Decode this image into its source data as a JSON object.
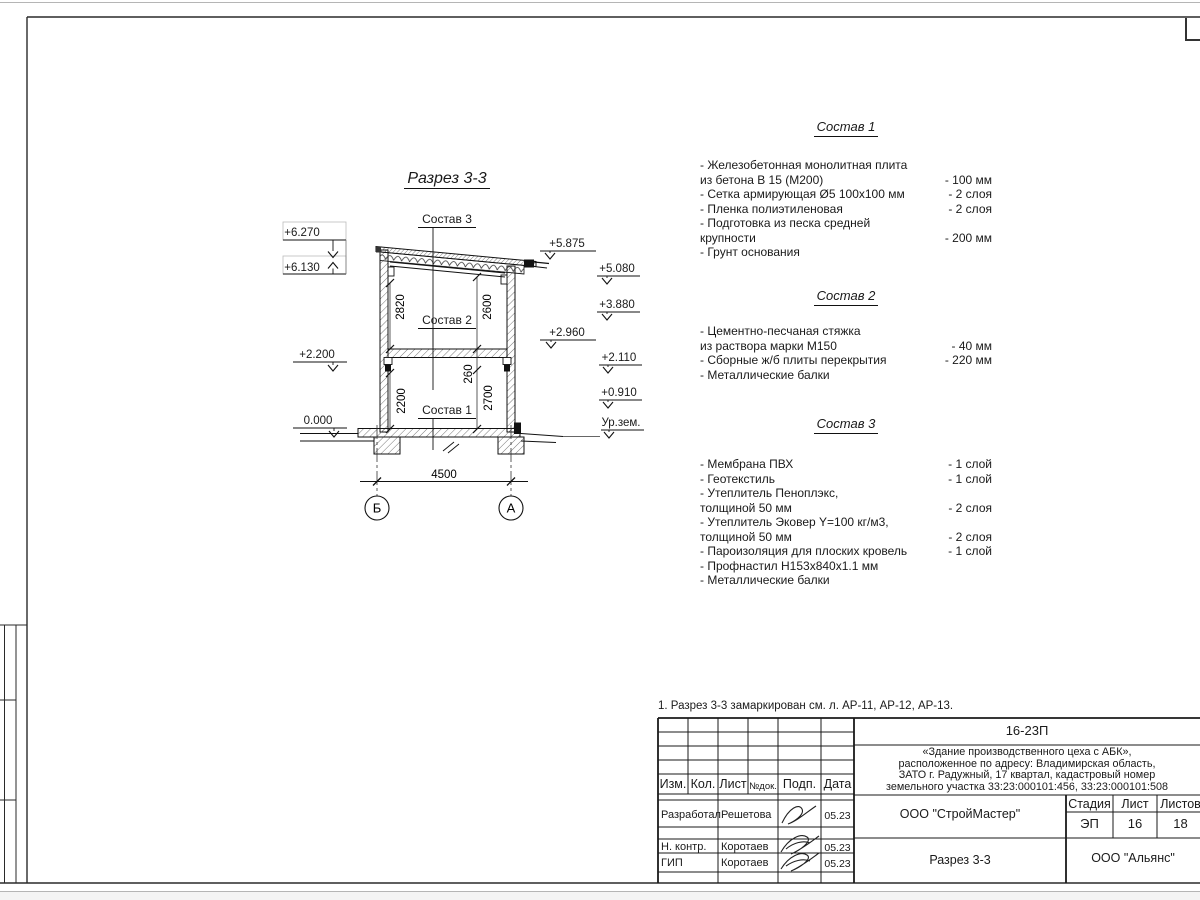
{
  "drawing": {
    "title": "Разрез 3-3",
    "callouts": [
      "Состав 3",
      "Состав 2",
      "Состав 1"
    ],
    "levels_left": [
      "+6.270",
      "+6.130",
      "+2.200",
      "0.000"
    ],
    "levels_right": [
      "+5.875",
      "+5.080",
      "+3.880",
      "+2.960",
      "+2.110",
      "+0.910",
      "Ур.зем."
    ],
    "dims": {
      "f2l": "2820",
      "f2r": "2600",
      "f1l": "2200",
      "f1r": "2700",
      "slab": "260",
      "span": "4500"
    },
    "axes": [
      "Б",
      "А"
    ]
  },
  "compositions": [
    {
      "title": "Состав 1",
      "items": [
        {
          "text": "- Железобетонная  монолитная плита\nиз бетона В 15 (М200)",
          "value": "- 100 мм"
        },
        {
          "text": "- Сетка армирующая Ø5 100х100 мм",
          "value": "- 2 слоя"
        },
        {
          "text": "- Пленка полиэтиленовая",
          "value": "- 2 слоя"
        },
        {
          "text": "- Подготовка из песка средней\nкрупности",
          "value": "- 200 мм"
        },
        {
          "text": "- Грунт основания",
          "value": ""
        }
      ]
    },
    {
      "title": "Состав 2",
      "items": [
        {
          "text": "- Цементно-песчаная стяжка\nиз раствора марки М150",
          "value": "- 40 мм"
        },
        {
          "text": "- Сборные ж/б плиты перекрытия",
          "value": "- 220 мм"
        },
        {
          "text": "- Металлические балки",
          "value": ""
        }
      ]
    },
    {
      "title": "Состав 3",
      "items": [
        {
          "text": "- Мембрана ПВХ",
          "value": "- 1 слой"
        },
        {
          "text": "- Геотекстиль",
          "value": "- 1 слой"
        },
        {
          "text": "- Утеплитель Пеноплэкс,\nтолщиной 50 мм",
          "value": "- 2 слоя"
        },
        {
          "text": "- Утеплитель Эковер Y=100 кг/м3,\nтолщиной 50 мм",
          "value": "- 2 слоя"
        },
        {
          "text": "- Пароизоляция для плоских кровель",
          "value": "- 1 слой"
        },
        {
          "text": "- Профнастил Н153х840х1.1 мм",
          "value": ""
        },
        {
          "text": "- Металлические балки",
          "value": ""
        }
      ]
    }
  ],
  "note": "1. Разрез 3-3 замаркирован см. л. АР-11, АР-12, АР-13.",
  "title_block": {
    "doc_number": "16-23П",
    "description_lines": [
      "«Здание производственного цеха с АБК»,",
      "расположенное по адресу: Владимирская область,",
      "ЗАТО г. Радужный, 17 квартал, кадастровый номер",
      "земельного участка 33:23:000101:456, 33:23:000101:508"
    ],
    "columns": [
      "Изм.",
      "Кол.",
      "Лист",
      "№док.",
      "Подп.",
      "Дата"
    ],
    "rows": [
      {
        "role": "Разработал",
        "name": "Решетова",
        "date": "05.23"
      },
      {
        "role": "Н. контр.",
        "name": "Коротаев",
        "date": "05.23"
      },
      {
        "role": "ГИП",
        "name": "Коротаев",
        "date": "05.23"
      }
    ],
    "organization": "ООО \"СтройМастер\"",
    "sheet_title": "Разрез 3-3",
    "contractor": "ООО \"Альянс\"",
    "stage_label": "Стадия",
    "sheet_label": "Лист",
    "sheets_label": "Листов",
    "stage": "ЭП",
    "sheet": "16",
    "sheets": "18"
  }
}
